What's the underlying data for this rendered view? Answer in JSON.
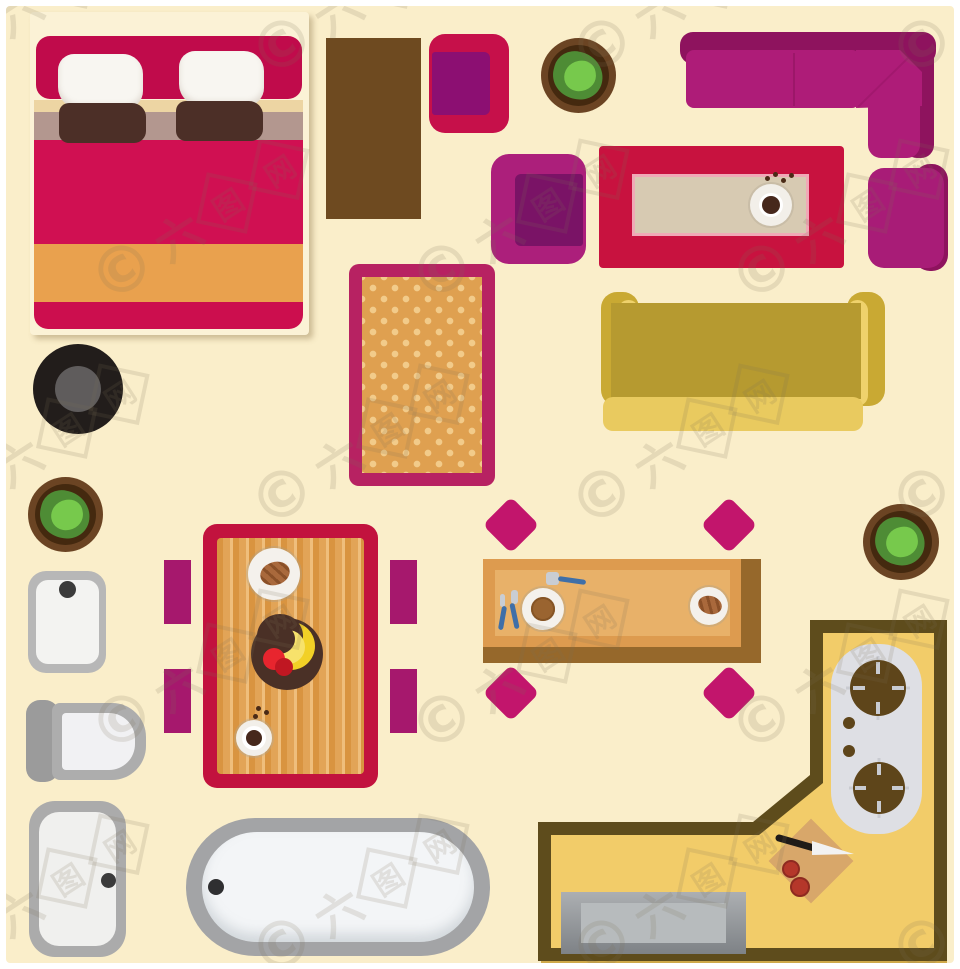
{
  "image_type": "top-view furniture floor plan illustration",
  "canvas": {
    "background": "#FAEECA",
    "frame": "#FFFFFF",
    "width": 960,
    "height": 969
  },
  "watermark": {
    "copyright_symbol": "©",
    "site_name": "六图网",
    "boxed_characters": [
      "图",
      "网"
    ],
    "color": "rgba(125,110,88,0.16)"
  },
  "palette": {
    "crimson": "#C8123F",
    "magenta": "#AC1F7B",
    "dark_magenta": "#8E135E",
    "purple_seat": "#8C0F72",
    "orange": "#E9A14E",
    "olive": "#B69A30",
    "olive_light": "#EFD26C",
    "wood": "#E2A457",
    "wood_dark": "#96682B",
    "counter_yellow": "#F2CC69",
    "counter_border": "#5E4C1C",
    "gray_fixture": "#ABABAB",
    "white_fixture": "#F3F3F1",
    "plant_green": "#4E8C35",
    "plant_light_green": "#77C94C",
    "pot_brown": "#6B4423"
  },
  "furniture_inventory": [
    {
      "name": "double-bed",
      "note": "red bedding, two white pillows, two brown pillows, orange stripe"
    },
    {
      "name": "brown-side-table"
    },
    {
      "name": "armchair-red-purple"
    },
    {
      "name": "armchair-magenta"
    },
    {
      "name": "armchair-with-backrest"
    },
    {
      "name": "corner-sofa-magenta"
    },
    {
      "name": "coffee-table-with-coffee-cup"
    },
    {
      "name": "sofa-olive"
    },
    {
      "name": "round-stool-black"
    },
    {
      "name": "rug-orange-starred"
    },
    {
      "name": "potted-plant",
      "count": 3
    },
    {
      "name": "dining-table-four-chairs",
      "items_on_top": [
        "pastry plate",
        "fruit bowl with bananas and apples",
        "coffee cup with beans"
      ]
    },
    {
      "name": "dining-table-four-diamond-chairs",
      "items_on_top": [
        "spoon",
        "burger plate with fork",
        "croissant plate"
      ]
    },
    {
      "name": "kitchen-counter-L-shaped",
      "items_on_top": [
        "two-burner stove",
        "cutting board with knife and tomatoes",
        "sink"
      ]
    },
    {
      "name": "washbasin"
    },
    {
      "name": "toilet"
    },
    {
      "name": "shower-tray"
    },
    {
      "name": "bathtub"
    }
  ]
}
